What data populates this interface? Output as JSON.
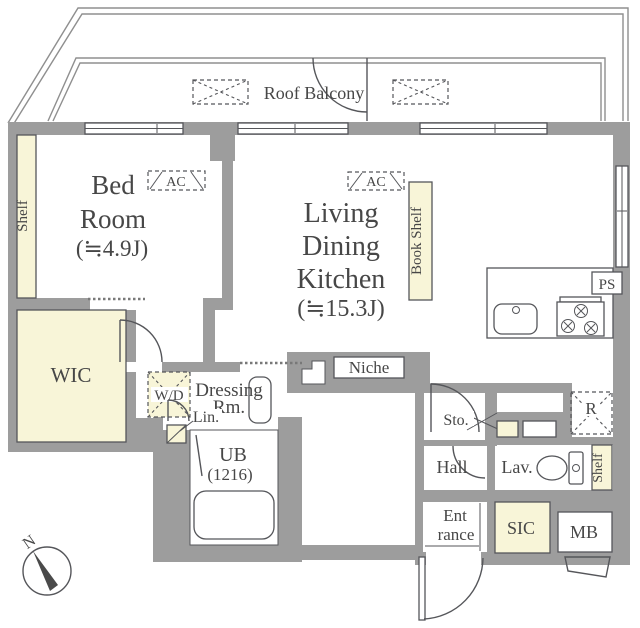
{
  "plan": {
    "balcony": {
      "label": "Roof Balcony"
    },
    "bedroom": {
      "line1": "Bed",
      "line2": "Room",
      "size": "(≒4.9J)",
      "shelf": "Shelf",
      "ac": "AC"
    },
    "ldk": {
      "line1": "Living",
      "line2": "Dining",
      "line3": "Kitchen",
      "size": "(≒15.3J)",
      "ac": "AC",
      "bookshelf": "Book Shelf",
      "niche": "Niche",
      "ps": "PS",
      "fridge": "R"
    },
    "wic": {
      "label": "WIC"
    },
    "sanitary": {
      "wd": "W/D",
      "dressing_line1": "Dressing",
      "dressing_line2": "Rm.",
      "lin": "Lin.",
      "ub_line1": "UB",
      "ub_line2": "(1216)"
    },
    "entry": {
      "sto": "Sto.",
      "hall": "Hall",
      "lav": "Lav.",
      "ent_line1": "Ent",
      "ent_line2": "rance",
      "sic": "SIC",
      "mb": "MB",
      "shelf": "Shelf"
    },
    "compass": {
      "north": "N"
    },
    "colors": {
      "wall": "#9d9d9d",
      "cream": "#f8f5d8",
      "line": "#55565a",
      "text": "#474747"
    }
  }
}
